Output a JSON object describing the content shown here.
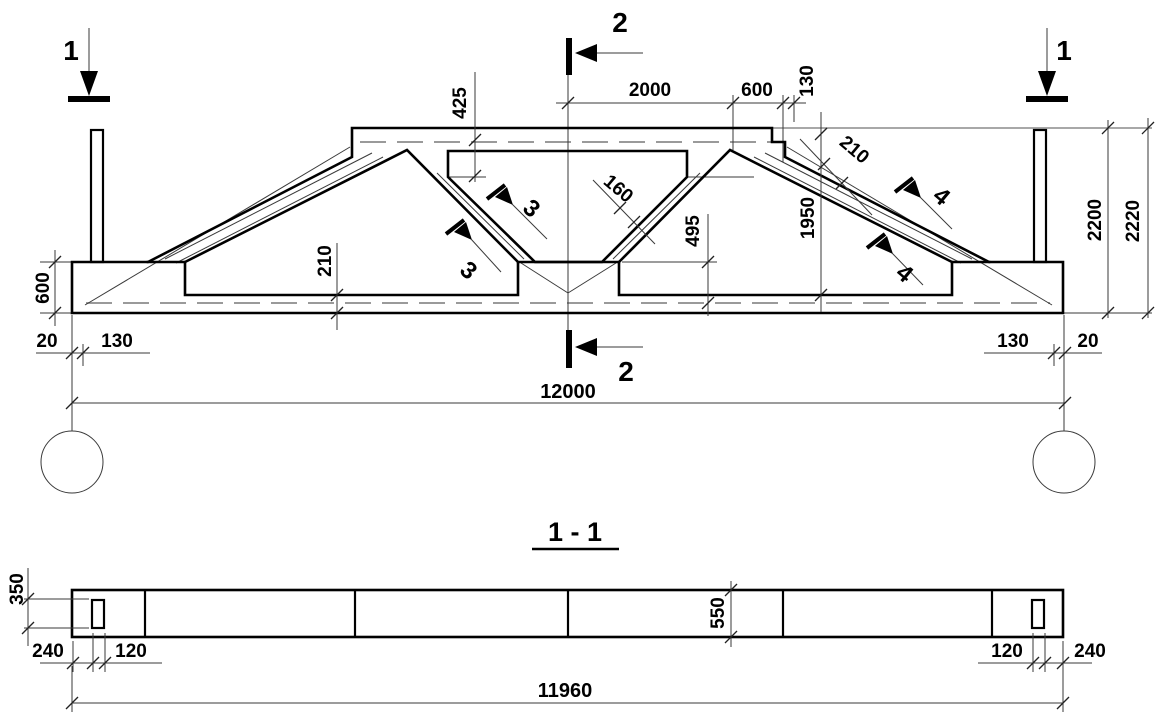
{
  "elevation": {
    "dim_425": "425",
    "dim_2000": "2000",
    "dim_600_top": "600",
    "dim_130_top": "130",
    "dim_210_chord": "210",
    "dim_210_slope": "210",
    "dim_160": "160",
    "dim_495": "495",
    "dim_1950": "1950",
    "dim_2200": "2200",
    "dim_2220": "2220",
    "dim_600_left": "600",
    "dim_20_left": "20",
    "dim_130_left": "130",
    "dim_130_right": "130",
    "dim_20_right": "20",
    "dim_12000": "12000",
    "marker_1_left": "1",
    "marker_1_right": "1",
    "marker_2_top": "2",
    "marker_2_bottom": "2",
    "marker_3_upper": "3",
    "marker_3_lower": "3",
    "marker_4_upper": "4",
    "marker_4_lower": "4"
  },
  "section_view": {
    "title": "1 - 1",
    "dim_350": "350",
    "dim_550": "550",
    "dim_240_left": "240",
    "dim_120_left": "120",
    "dim_120_right": "120",
    "dim_240_right": "240",
    "dim_11960": "11960"
  },
  "colors": {
    "line": "#000000",
    "thin_line": "#3a3a3a",
    "rebar_line": "#8c8c8c",
    "background": "#ffffff"
  }
}
